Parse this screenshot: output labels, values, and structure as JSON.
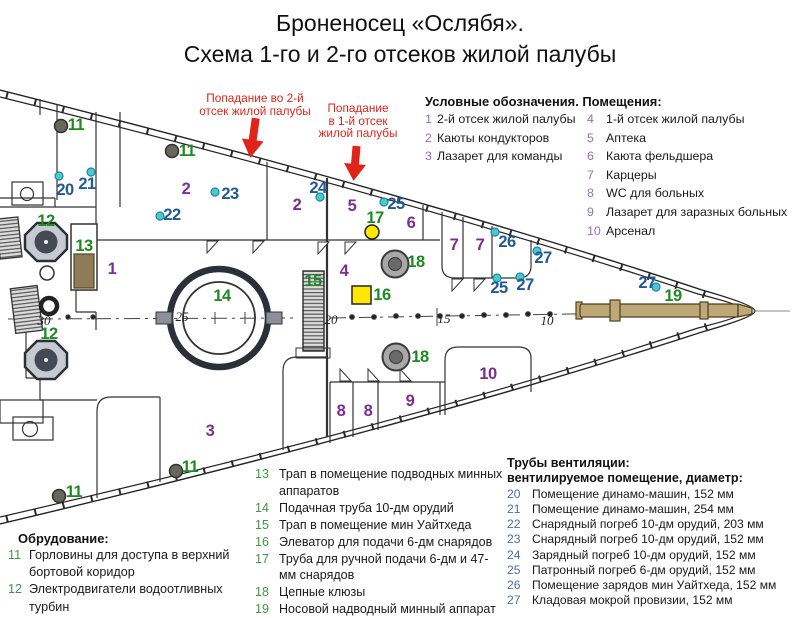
{
  "title": {
    "line1": "Броненосец «Ослябя».",
    "line2": "Схема 1-го и 2-го отсеков жилой палубы"
  },
  "annotations": {
    "hit2": {
      "line1": "Попадание во 2-й",
      "line2": "отсек жилой палубы"
    },
    "hit1": {
      "line1": "Попадание",
      "line2": "в 1-й отсек",
      "line3": "жилой палубы"
    }
  },
  "legend_rooms": {
    "header": "Условные обозначения. Помещения:",
    "col1": [
      {
        "num": "1",
        "text": "2-й отсек жилой палубы"
      },
      {
        "num": "2",
        "text": "Каюты кондукторов"
      },
      {
        "num": "3",
        "text": "Лазарет для команды"
      }
    ],
    "col2": [
      {
        "num": "4",
        "text": "1-й отсек жилой палубы"
      },
      {
        "num": "5",
        "text": "Аптека"
      },
      {
        "num": "6",
        "text": "Каюта фельдшера"
      },
      {
        "num": "7",
        "text": "Карцеры"
      },
      {
        "num": "8",
        "text": "WC для больных"
      },
      {
        "num": "9",
        "text": "Лазарет для заразных больных"
      },
      {
        "num": "10",
        "text": "Арсенал"
      }
    ]
  },
  "equipment": {
    "header": "Обрудование:",
    "items": [
      {
        "num": "11",
        "text": "Горловины для доступа в верхний бортовой коридор"
      },
      {
        "num": "12",
        "text": "Электродвигатели водоотливных турбин"
      }
    ]
  },
  "fittings": {
    "items": [
      {
        "num": "13",
        "text": "Трап в помещение подводных минных аппаратов"
      },
      {
        "num": "14",
        "text": "Подачная труба 10-дм орудий"
      },
      {
        "num": "15",
        "text": "Трап в помещение мин Уайтхеда"
      },
      {
        "num": "16",
        "text": "Элеватор для подачи 6-дм снарядов"
      },
      {
        "num": "17",
        "text": "Труба для ручной подачи 6-дм и 47-мм снарядов"
      },
      {
        "num": "18",
        "text": "Цепные клюзы"
      },
      {
        "num": "19",
        "text": "Носовой надводный минный аппарат"
      }
    ]
  },
  "ventilation": {
    "header1": "Трубы вентиляции:",
    "header2": "вентилируемое помещение, диаметр:",
    "items": [
      {
        "num": "20",
        "text": "Помещение динамо-машин, 152 мм"
      },
      {
        "num": "21",
        "text": "Помещение динамо-машин, 254 мм"
      },
      {
        "num": "22",
        "text": "Снарядный погреб 10-дм орудий, 203 мм"
      },
      {
        "num": "23",
        "text": "Снарядный погреб 10-дм орудий, 152 мм"
      },
      {
        "num": "24",
        "text": "Зарядный погреб 10-дм орудий, 152 мм"
      },
      {
        "num": "25",
        "text": "Патронный погреб 6-дм орудий, 152 мм"
      },
      {
        "num": "26",
        "text": "Помещение зарядов мин Уайтхеда, 152 мм"
      },
      {
        "num": "27",
        "text": "Кладовая мокрой провизии, 152 мм"
      }
    ]
  },
  "diagram": {
    "labels": [
      {
        "t": "1",
        "x": 112,
        "y": 269,
        "c": "p"
      },
      {
        "t": "2",
        "x": 186,
        "y": 189,
        "c": "p"
      },
      {
        "t": "2",
        "x": 297,
        "y": 205,
        "c": "p"
      },
      {
        "t": "3",
        "x": 210,
        "y": 431,
        "c": "p"
      },
      {
        "t": "4",
        "x": 344,
        "y": 271,
        "c": "p"
      },
      {
        "t": "5",
        "x": 352,
        "y": 206,
        "c": "p"
      },
      {
        "t": "6",
        "x": 411,
        "y": 223,
        "c": "p"
      },
      {
        "t": "7",
        "x": 454,
        "y": 245,
        "c": "p"
      },
      {
        "t": "7",
        "x": 480,
        "y": 245,
        "c": "p"
      },
      {
        "t": "8",
        "x": 341,
        "y": 411,
        "c": "p"
      },
      {
        "t": "8",
        "x": 368,
        "y": 411,
        "c": "p"
      },
      {
        "t": "9",
        "x": 410,
        "y": 401,
        "c": "p"
      },
      {
        "t": "10",
        "x": 488,
        "y": 374,
        "c": "p"
      },
      {
        "t": "11",
        "x": 76,
        "y": 125,
        "c": "g"
      },
      {
        "t": "11",
        "x": 187,
        "y": 151,
        "c": "g"
      },
      {
        "t": "11",
        "x": 74,
        "y": 492,
        "c": "g"
      },
      {
        "t": "11",
        "x": 190,
        "y": 467,
        "c": "g"
      },
      {
        "t": "12",
        "x": 46,
        "y": 221,
        "c": "g"
      },
      {
        "t": "12",
        "x": 49,
        "y": 334,
        "c": "g"
      },
      {
        "t": "13",
        "x": 84,
        "y": 246,
        "c": "g"
      },
      {
        "t": "14",
        "x": 222,
        "y": 296,
        "c": "g"
      },
      {
        "t": "15",
        "x": 313,
        "y": 281,
        "c": "g"
      },
      {
        "t": "16",
        "x": 382,
        "y": 295,
        "c": "g"
      },
      {
        "t": "17",
        "x": 375,
        "y": 218,
        "c": "g"
      },
      {
        "t": "18",
        "x": 416,
        "y": 262,
        "c": "g"
      },
      {
        "t": "18",
        "x": 420,
        "y": 357,
        "c": "g"
      },
      {
        "t": "19",
        "x": 673,
        "y": 296,
        "c": "g"
      },
      {
        "t": "20",
        "x": 65,
        "y": 190,
        "c": "b"
      },
      {
        "t": "21",
        "x": 87,
        "y": 184,
        "c": "b"
      },
      {
        "t": "22",
        "x": 172,
        "y": 215,
        "c": "b"
      },
      {
        "t": "23",
        "x": 230,
        "y": 194,
        "c": "b"
      },
      {
        "t": "24",
        "x": 318,
        "y": 188,
        "c": "b"
      },
      {
        "t": "25",
        "x": 396,
        "y": 204,
        "c": "b"
      },
      {
        "t": "25",
        "x": 499,
        "y": 288,
        "c": "b"
      },
      {
        "t": "26",
        "x": 507,
        "y": 242,
        "c": "b"
      },
      {
        "t": "27",
        "x": 543,
        "y": 258,
        "c": "b"
      },
      {
        "t": "27",
        "x": 525,
        "y": 285,
        "c": "b"
      },
      {
        "t": "27",
        "x": 647,
        "y": 283,
        "c": "b"
      }
    ],
    "frame_numbers": [
      {
        "t": "30",
        "x": 44,
        "y": 321
      },
      {
        "t": "25",
        "x": 182,
        "y": 317
      },
      {
        "t": "20",
        "x": 331,
        "y": 320
      },
      {
        "t": "15",
        "x": 444,
        "y": 319
      },
      {
        "t": "10",
        "x": 547,
        "y": 321
      }
    ]
  },
  "colors": {
    "purple": "#7b2e92",
    "legendPurple": "#9a6fb0",
    "green": "#1e8a22",
    "legendGreen": "#3f9844",
    "blue": "#1f5a96",
    "legendBlue": "#4a6f9e",
    "red": "#e0241a",
    "cyanDot": "#4cc8d2",
    "cyanDotStroke": "#1d8a96",
    "yellow": "#ffe800"
  }
}
